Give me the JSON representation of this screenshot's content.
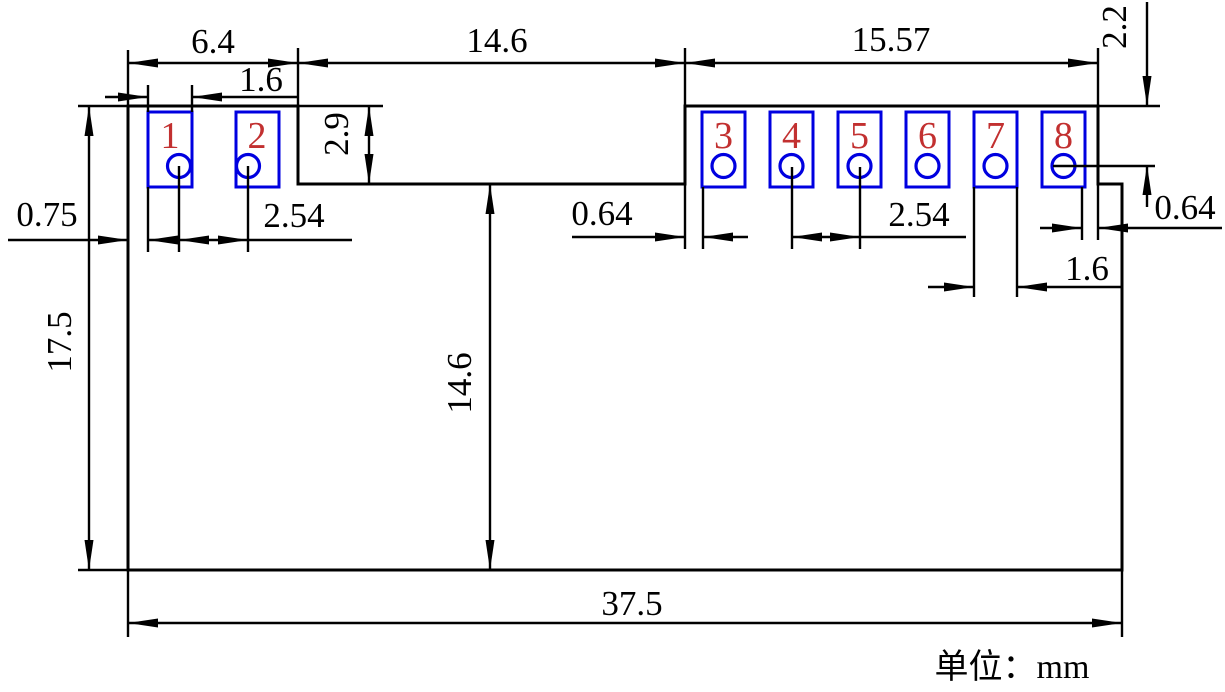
{
  "drawing": {
    "unit_note": "单位：mm",
    "colors": {
      "line": "#000000",
      "pad_outline": "#0000E0",
      "pad_number": "#C23030",
      "background": "#FFFFFF"
    },
    "pads": [
      {
        "number": "1"
      },
      {
        "number": "2"
      },
      {
        "number": "3"
      },
      {
        "number": "4"
      },
      {
        "number": "5"
      },
      {
        "number": "6"
      },
      {
        "number": "7"
      },
      {
        "number": "8"
      }
    ],
    "dims": {
      "top_left_width": "6.4",
      "notch_width": "14.6",
      "top_right_width": "15.57",
      "pad1_width": "1.6",
      "notch_depth": "2.9",
      "edge_to_pad1": "0.75",
      "pitch_left": "2.54",
      "pin3_inset": "0.64",
      "pitch_right": "2.54",
      "pad7_width": "1.6",
      "pad8_to_edge": "0.64",
      "top_to_pin_center": "2.2",
      "body_height": "17.5",
      "notch_to_bottom": "14.6",
      "overall_width": "37.5"
    }
  }
}
